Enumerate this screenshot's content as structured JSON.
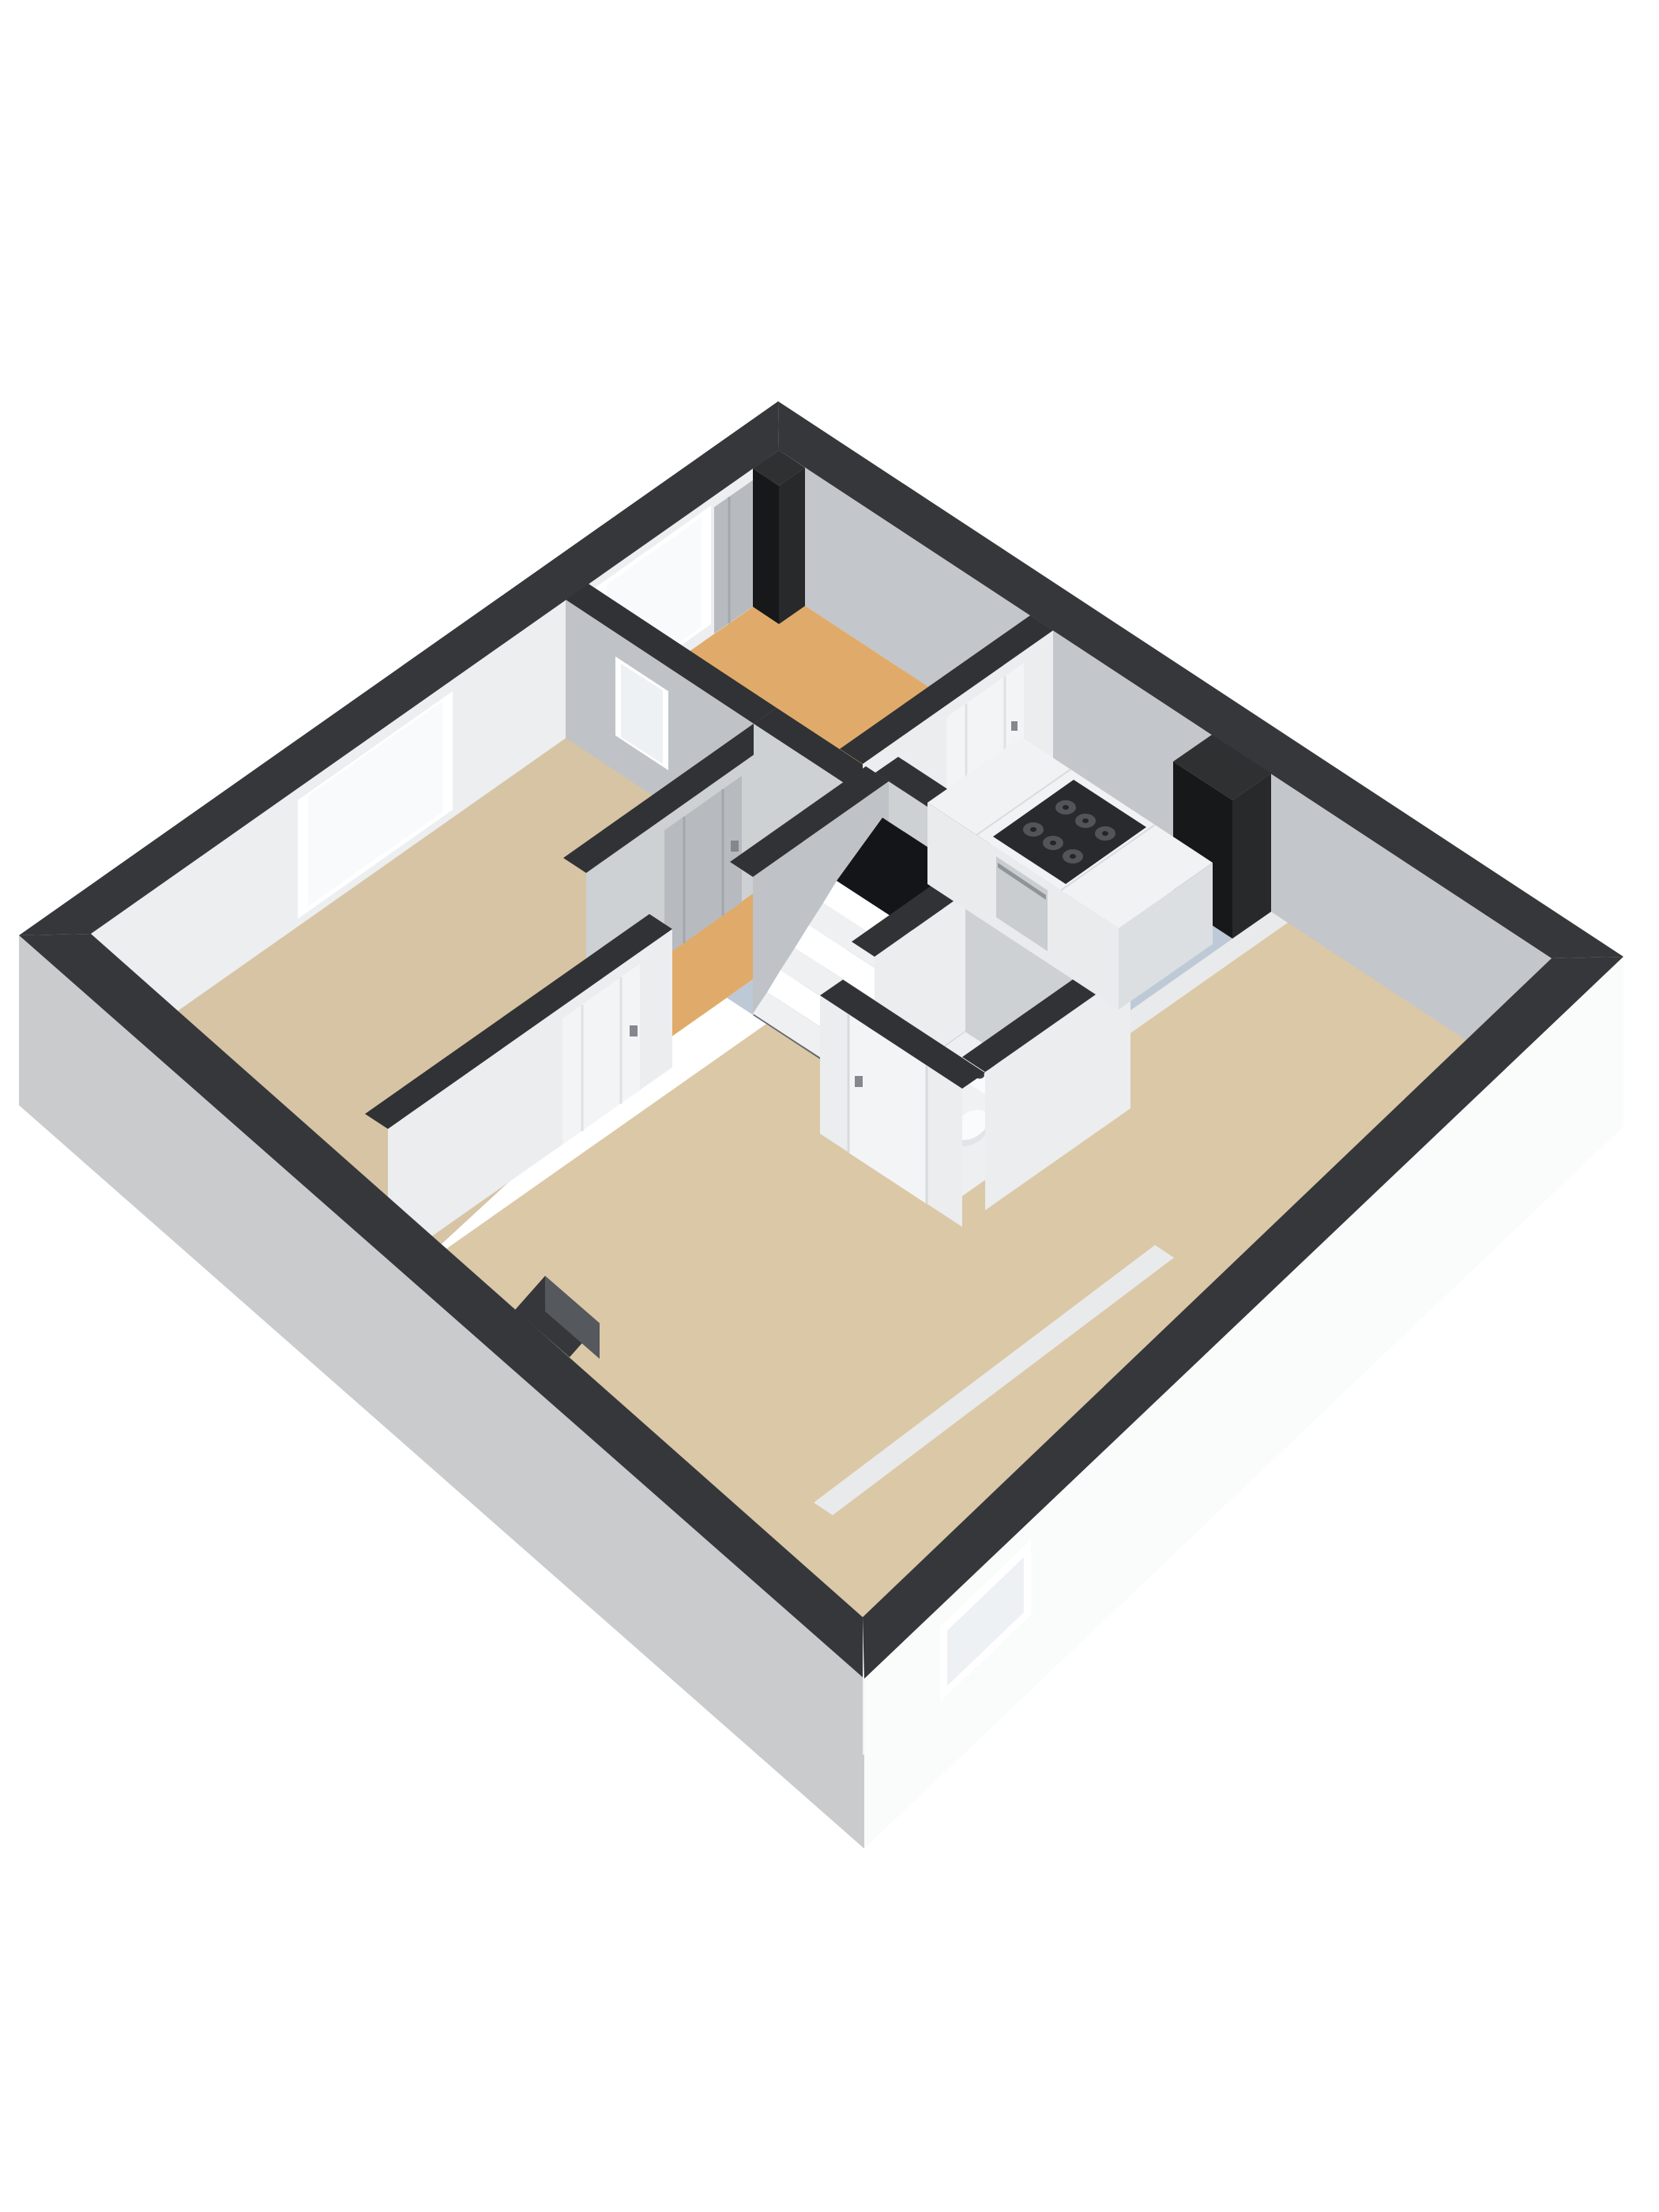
{
  "scene": {
    "kind": "isometric-3d-floor-plan-render",
    "rooms": [
      {
        "id": "entry-hall",
        "floor_color_key": "floor_orange"
      },
      {
        "id": "kitchen",
        "floor_color_key": "floor_blue"
      },
      {
        "id": "living-dining-room",
        "floor_color_key": "floor_tan"
      },
      {
        "id": "left-room",
        "floor_color_key": "floor_tan_left"
      },
      {
        "id": "wc",
        "floor_color_key": "floor_wc"
      },
      {
        "id": "stairwell",
        "floor_color_key": "stair_pit"
      }
    ],
    "furniture": [
      "kitchen-island-with-gas-stove-and-oven",
      "toilet",
      "staircase"
    ],
    "stove_burner_count": 6,
    "toilet_button_count": 2,
    "window_count": 5,
    "door_count": 5
  },
  "colors": {
    "background": "#ffffff",
    "cap_dark": "#35373b",
    "cap_interior": "#303235",
    "nw_inner": "#eceef0",
    "ne_inner": "#c3c6ca",
    "sw_inner": "#e8eaec",
    "se_inner": "#f1f2f3",
    "sw_outer": "#c9cbcd",
    "se_outer": "#fafbfb",
    "floor_orange": "#e0ab6a",
    "floor_blue": "#bec9d7",
    "floor_tan": "#dbc8a7",
    "floor_tan_left": "#d6c4a4",
    "floor_wc": "#edeff0",
    "threshold": "#e9eaeb",
    "wall_face_light": "#ebedef",
    "wall_face_mid": "#cdd1d4",
    "wall_face_gray": "#bfc3c7",
    "door_gray": "#b7bbc0",
    "door_white": "#f3f4f6",
    "handle": "#82888d",
    "panel_line_gray": "#a2a7ac",
    "panel_line_white": "#dfe1e3",
    "door_edge": "#d7dadc",
    "window_frame": "#ffffff",
    "glass": "#f8fafb",
    "glass_frosted": "#eef1f3",
    "island_top": "#f1f2f4",
    "island_front": "#e9ebed",
    "island_side": "#dcdfe1",
    "island_seam": "#d9dcde",
    "stove_top": "#282a2d",
    "burner": "#51555a",
    "burner_center": "#232528",
    "oven_front": "#c9cdd0",
    "oven_handle": "#8f9499",
    "column_dark": "#17181a",
    "column_side": "#27292b",
    "column_cap": "#2e3032",
    "stair_void": "#141518",
    "stair_pit": "#63676b",
    "stair_tread": "#ffffff",
    "stair_tread_alt": "#eef0f1",
    "notch_face": "#55585c",
    "toilet_white": "#fafbfc",
    "toilet_front": "#eff1f3",
    "toilet_side": "#e2e5e7",
    "toilet_dark": "#3b3e41"
  }
}
